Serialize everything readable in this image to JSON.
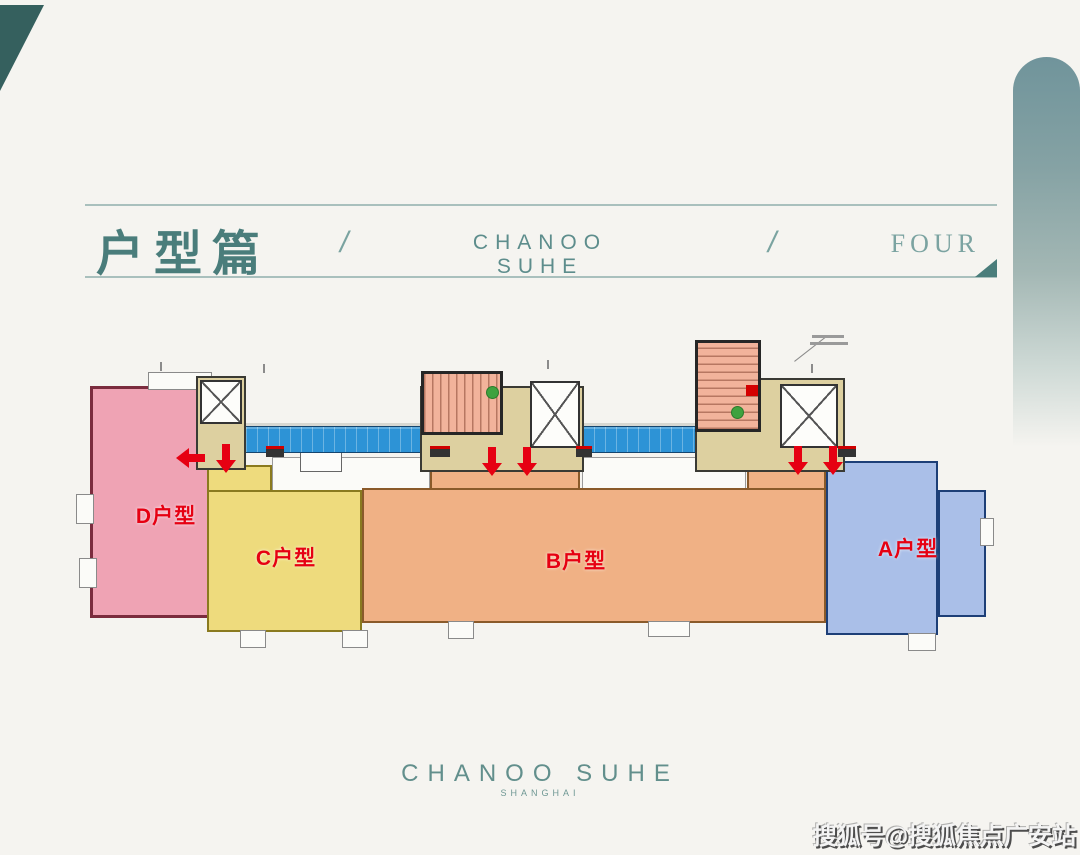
{
  "page": {
    "background": "#f5f4f0"
  },
  "decor": {
    "corner_accent_color": "#35605e",
    "arch_color": "#70949b"
  },
  "header": {
    "title": "户型篇",
    "separator_left": "/",
    "brand": "CHANOO SUHE",
    "separator_right": "/",
    "chapter": "FOUR",
    "accent_color": "#4a7d7b"
  },
  "floor_plan": {
    "units": [
      {
        "id": "A",
        "label": "A户型",
        "fill": "#aabfe8",
        "wall": "#1d3f77"
      },
      {
        "id": "B",
        "label": "B户型",
        "fill": "#f0b185",
        "wall": "#8a5a2a"
      },
      {
        "id": "C",
        "label": "C户型",
        "fill": "#eedb7d",
        "wall": "#8a7a1f"
      },
      {
        "id": "D",
        "label": "D户型",
        "fill": "#efa3b4",
        "wall": "#7b2c3e"
      }
    ],
    "label_color": "#e60012",
    "corridor_color": "#2d93d6",
    "lobby_color": "#ddd0a0",
    "stair_color": "#f2b39b",
    "arrow_color": "#e60012",
    "exit_dot_color": "#3fa23f"
  },
  "footer": {
    "brand": "CHANOO SUHE",
    "subtitle": "SHANGHAI"
  },
  "watermark": {
    "text": "搜狐号@搜狐焦点广安站"
  }
}
